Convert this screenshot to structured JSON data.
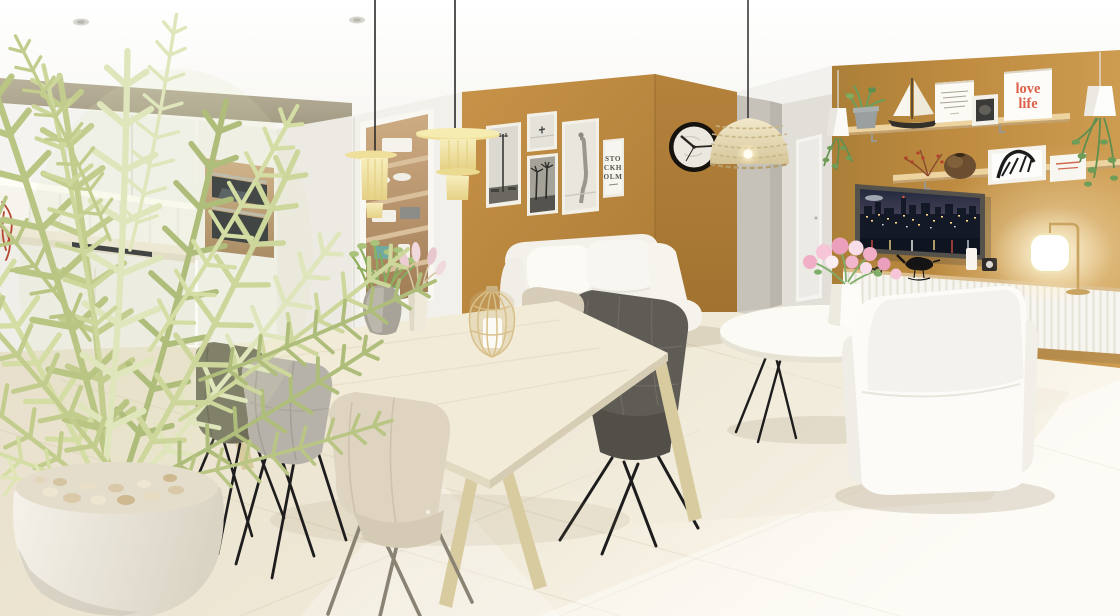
{
  "scene": {
    "description": "3D architectural rendering of a bright scandinavian open-plan apartment: white kitchen with built-in ovens on the left, light dining table with upholstered chairs under two yellow pendant lamps, white sofa and armchairs, round coffee table with pink flowers, ochre feature walls with a gallery of framed prints, wall clock, rattan pendant lamp, TV showing a night city skyline, wooden shelves with decor and a white ribbed sideboard with a glowing table lamp",
    "room_type": "open-plan living / dining / kitchen",
    "lighting": "warm daylight from the right, under-cabinet LED in kitchen, lit table lamp"
  },
  "posters": {
    "stockholm": {
      "line1": "STO",
      "line2": "CKH",
      "line3": "OLM"
    },
    "love_life": {
      "line1": "love",
      "line2": "life"
    }
  },
  "clock": {
    "time": "10:15"
  },
  "palette": {
    "accent_wall": "#bf8c41",
    "accent_wall_dark": "#a87a36",
    "ceiling": "#f9f8f4",
    "kitchen_soffit": "#b1a991",
    "floor": "#ece4d0",
    "floor_bright": "#fbf8ee",
    "hallway_wall": "#c6c2b9",
    "sofa_white": "#f6f4ee",
    "table_top": "#f0e9d5",
    "pendant_yellow": "#f2e6a8",
    "rattan": "#e9ddb9",
    "chair_olive": "#6f6d5a",
    "chair_light_grey": "#b7b2a9",
    "chair_cream": "#ded4c0",
    "chair_dark_grey": "#5e5c55",
    "poster_red": "#dd6048",
    "wood_shelf": "#e6cb96",
    "tv_frame": "#55514b",
    "flower_pink": "#f0aec7",
    "plant_green": "#c5cf92"
  },
  "inventory": [
    "white kitchen upper and base cabinets with LED strip",
    "tall column with two built-in dark glass ovens",
    "recessed display cabinet with dishes, towels and plant",
    "gallery wall: street-lamp photo, beach print, palm-trees photo, figure photo, STOCKHOLM typography poster",
    "black rim wall clock",
    "woven rattan dome pendant over sofa",
    "two tiered pale-yellow pendant lamps over dining table",
    "dining table with stone vase plant, pink pampas vase and rattan candle lantern",
    "five upholstered shell dining chairs (olive, grey, cream, beige)",
    "white two-seat sofa with cushions",
    "dark grey armchair",
    "round white coffee table with hairpin legs and pink bouquet",
    "white slipcover armchair seen from behind",
    "TV with night skyline on ochre wall",
    "two wooden wall shelves with sailboat model, framed prints, love life poster, zebra print, berry branch, round vase and plants",
    "white ribbed sideboard with sunglasses, bird figurine, candle and brass table lamp",
    "two small white cone pendant lights with trailing plants",
    "large potted feathery green plant in white pot (foreground)"
  ]
}
